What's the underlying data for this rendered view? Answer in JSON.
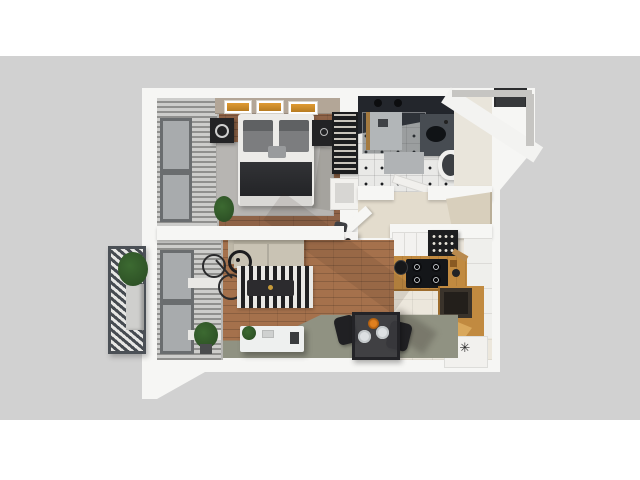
{
  "scene": {
    "type": "3d-floor-plan-render",
    "description": "Top-down 3D render of a one-bedroom apartment with balcony",
    "letterbox": "white bars top and bottom, gray canvas center"
  },
  "palette": {
    "letterbox_white": "#ffffff",
    "bg_gray": "#d1d1d1",
    "wall_white": "#f6f6f4",
    "wall_tan": "#b3a697",
    "bedroom_wood": "#8f6347",
    "living_wood": "#a5714c",
    "rug_gray": "#b7b5b2",
    "bed_white": "#ecebe8",
    "pillow_gray": "#7c7d7f",
    "throw_dark": "#323336",
    "nightstand_dark": "#232325",
    "frame_orange": "#e09b33",
    "blinds_light": "#cdcdcb",
    "blinds_dark": "#90908e",
    "window_frame": "#6a6d6f",
    "bath_tile_dark": "#23262c",
    "bath_floor": "#e9e9e7",
    "bath_dot": "#1c1e21",
    "vanity_gray": "#b2b6b8",
    "sink_dark": "#101316",
    "toilet_white": "#f0f0ee",
    "toilet_seat": "#3c3f43",
    "hall_floor": "#e3dccd",
    "door_tan": "#d8cfbc",
    "kitchen_floor": "#ece7dc",
    "counter_wood": "#c18a40",
    "counter_wood_dark": "#9d6c2c",
    "cooktop_black": "#141619",
    "rack_black": "#1c1d1f",
    "oven_dark": "#3a332b",
    "sage_floor": "#909282",
    "sofa_beige": "#c9c3b4",
    "stripe_white": "#e9e8e5",
    "stripe_black": "#202022",
    "accent_orange": "#e0801f",
    "plant_green": "#3c6a31",
    "plant_green_dark": "#2e5226",
    "balcony_frame": "#4b5056",
    "balcony_slat_light": "#e7e7e5",
    "balcony_slat_dark": "#464b51"
  },
  "icons": {
    "fan_glyph": "✳"
  },
  "rooms": [
    {
      "name": "bedroom",
      "position": "top-left",
      "floor": "wood planks",
      "furniture": [
        "double bed with dark throw",
        "two dark nightstands with speakers",
        "gray area rug",
        "three orange wall pictures",
        "window blinds",
        "potted plant"
      ]
    },
    {
      "name": "bathroom",
      "position": "top-right",
      "floor": "white tile with black diamond dots",
      "furniture": [
        "dark tiled wall",
        "walk-in shower with two heads",
        "vanity with dark basin",
        "wood-trimmed washstand",
        "toilet",
        "gray bath mat"
      ]
    },
    {
      "name": "hallway",
      "position": "center-right",
      "floor": "beige",
      "furniture": [
        "entrance door ajar",
        "small white desk with laptop",
        "chair"
      ]
    },
    {
      "name": "kitchen",
      "position": "bottom-right",
      "floor": "beige tile",
      "furniture": [
        "L-shaped wooden counter",
        "four-burner cooktop",
        "wine rack with bottles",
        "white fridge cabinet",
        "oven with cutting board",
        "base cabinet with vent fan"
      ]
    },
    {
      "name": "living-dining",
      "position": "bottom-left",
      "floor": "wood planks and sage-green strip",
      "furniture": [
        "beige sofa",
        "black floor lamp",
        "bicycle at window",
        "black-and-white striped rug",
        "dark coffee table",
        "white TV bench with plant",
        "square dining table with plates and orange centerpiece",
        "two black chairs",
        "potted plant"
      ]
    },
    {
      "name": "balcony",
      "position": "outside-left",
      "floor": "dark slatted deck",
      "furniture": [
        "potted plant with tall gray planter"
      ]
    }
  ]
}
